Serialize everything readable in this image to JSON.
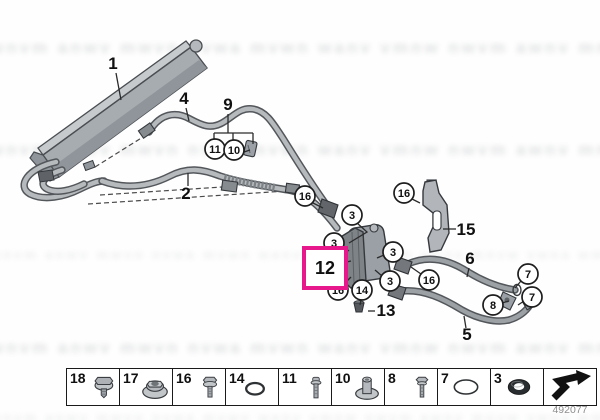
{
  "diagram": {
    "labels": {
      "l1": "1",
      "l2": "2",
      "l4": "4",
      "l5": "5",
      "l6": "6",
      "l9": "9",
      "l12": "12",
      "l13": "13",
      "l15": "15"
    },
    "callouts": {
      "c3": "3",
      "c7": "7",
      "c8": "8",
      "c10": "10",
      "c11": "11",
      "c14": "14",
      "c16": "16"
    },
    "highlight_color": "#e6188c",
    "doc_number": "492077",
    "watermark_text": "wnvm anwv mwvn nvwa mvwn wanv vmnw nwvm awnv mnvw vwna wmvn nawv wvnm mnwa vnwm wamn nvmw"
  },
  "legend": {
    "cells": [
      {
        "number": "18",
        "icon": "hex-bolt-washer-icon"
      },
      {
        "number": "17",
        "icon": "flange-nut-icon"
      },
      {
        "number": "16",
        "icon": "hex-flange-bolt-icon"
      },
      {
        "number": "14",
        "icon": "o-ring-icon"
      },
      {
        "number": "11",
        "icon": "round-head-bolt-icon"
      },
      {
        "number": "10",
        "icon": "flanged-sleeve-icon"
      },
      {
        "number": "8",
        "icon": "hex-bolt-icon"
      },
      {
        "number": "7",
        "icon": "large-o-ring-icon"
      },
      {
        "number": "3",
        "icon": "seal-ring-icon"
      },
      {
        "number": "",
        "icon": "continuation-arrow-icon"
      }
    ]
  }
}
